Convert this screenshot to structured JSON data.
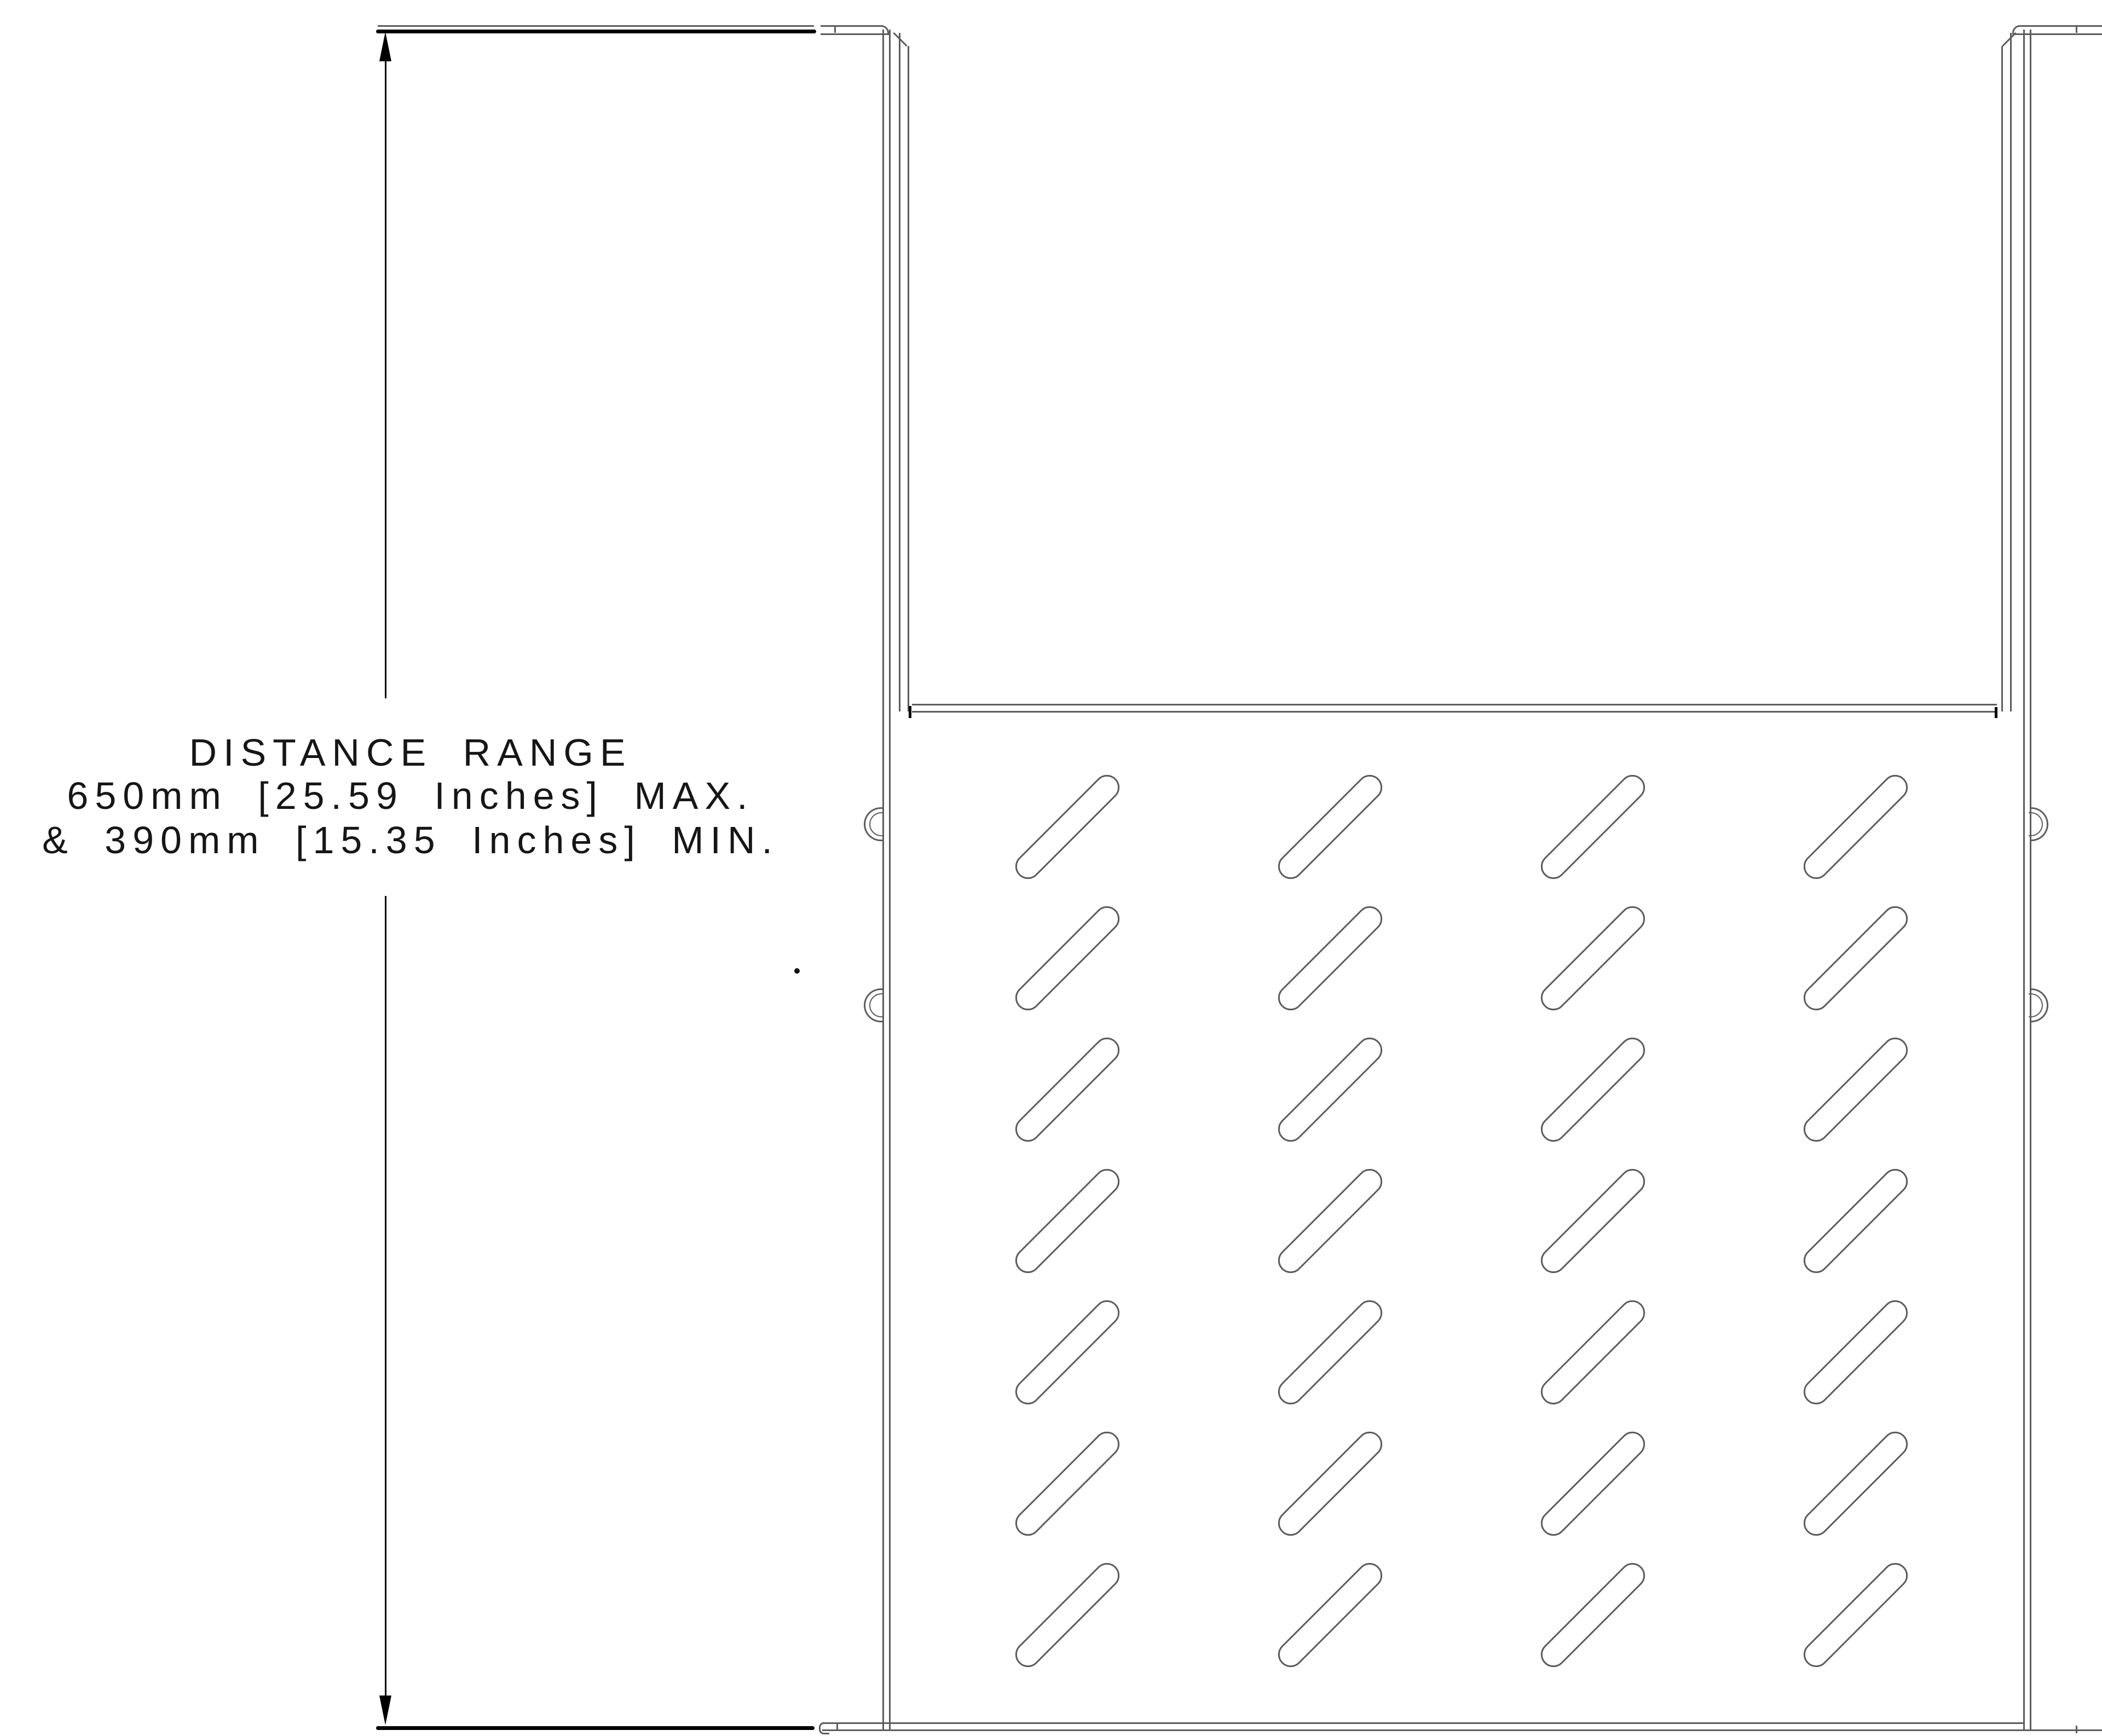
{
  "annotation": {
    "line1": "DISTANCE RANGE",
    "line2": "650mm [25.59 Inches] MAX.",
    "line3": "& 390mm [15.35 Inches] MIN."
  },
  "drawing": {
    "slot_grid": {
      "rows": 7,
      "cols": 4
    },
    "colors": {
      "line": "#5c5c5c",
      "accent": "#000000"
    }
  }
}
